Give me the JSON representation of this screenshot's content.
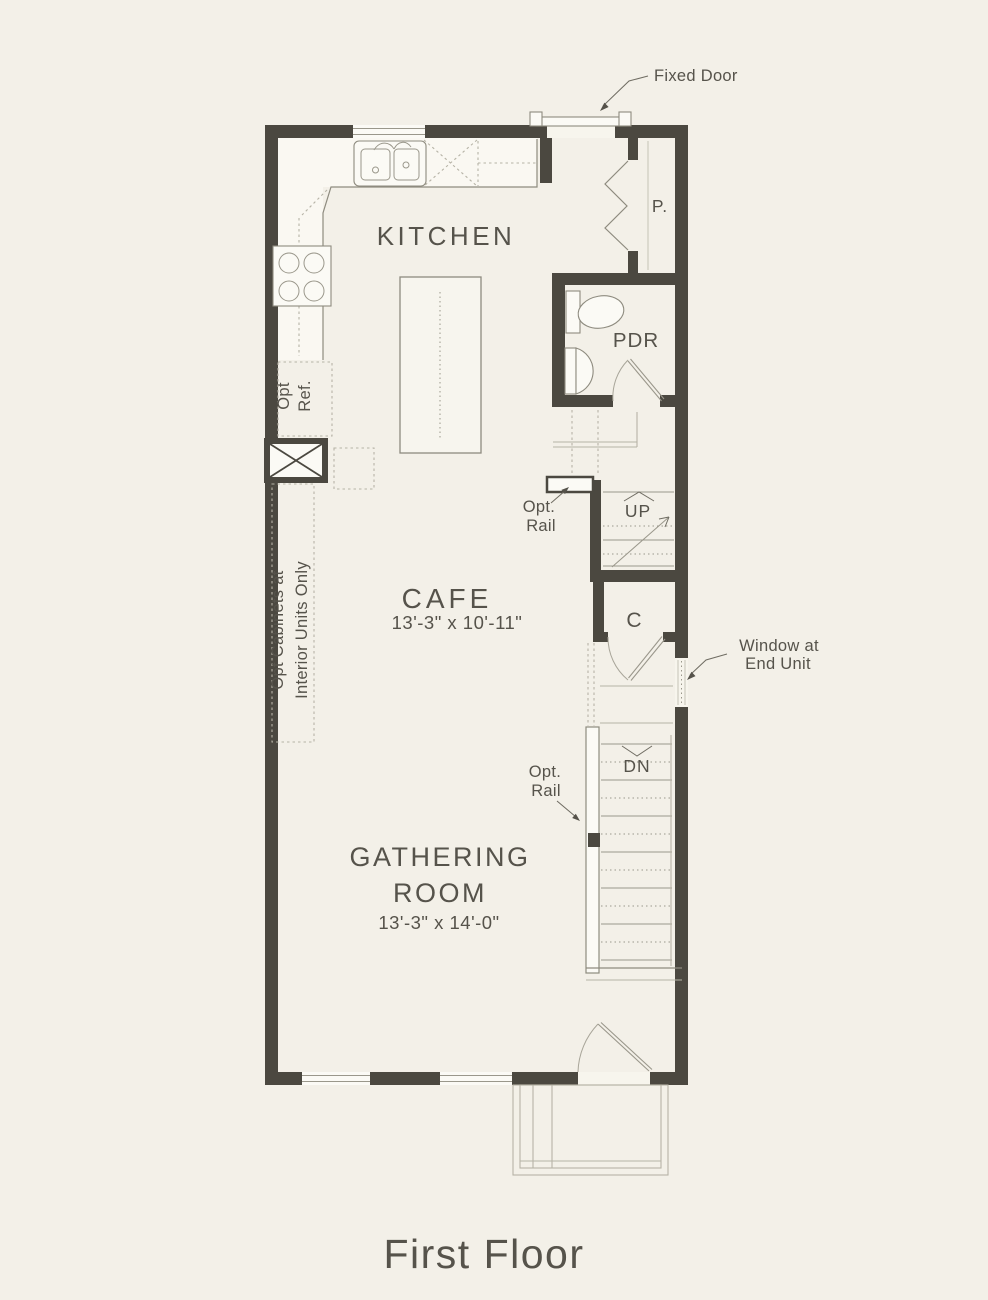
{
  "colors": {
    "background": "#f3f0e8",
    "wall": "#4b4840",
    "line": "#8e8b7f",
    "text": "#56534b"
  },
  "plan": {
    "title": "First Floor",
    "rooms": {
      "kitchen": {
        "label": "KITCHEN"
      },
      "cafe": {
        "label": "CAFE",
        "dimensions": "13'-3\" x 10'-11\""
      },
      "gathering": {
        "label_line1": "GATHERING",
        "label_line2": "ROOM",
        "dimensions": "13'-3\" x 14'-0\""
      },
      "pantry": {
        "label": "P."
      },
      "powder": {
        "label": "PDR"
      },
      "closet": {
        "label": "C"
      }
    },
    "stairs": {
      "up_label": "UP",
      "down_label": "DN"
    },
    "callouts": {
      "fixed_door": "Fixed Door",
      "window_line1": "Window at",
      "window_line2": "End Unit",
      "opt_rail_line1": "Opt.",
      "opt_rail_line2": "Rail",
      "opt_ref_line1": "Opt",
      "opt_ref_line2": "Ref.",
      "opt_cabinets_line1": "Opt Cabinets at",
      "opt_cabinets_line2": "Interior Units Only"
    }
  }
}
